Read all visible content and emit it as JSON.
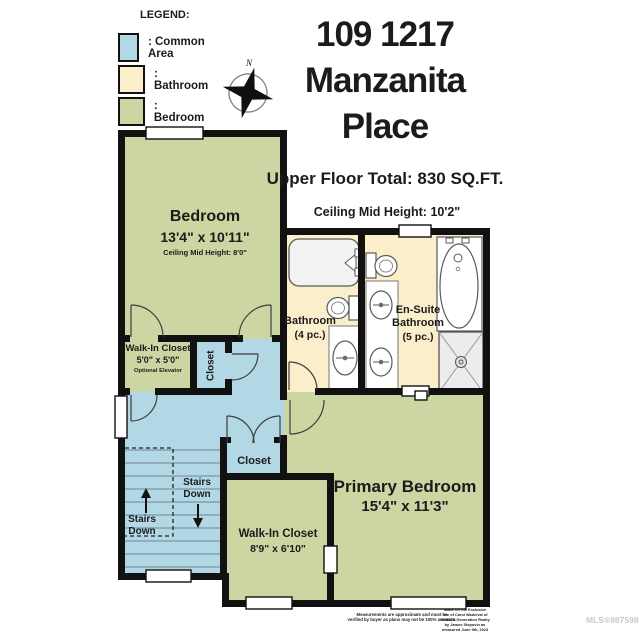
{
  "legend": {
    "title": "LEGEND:",
    "items": [
      {
        "label": ": Common Area",
        "color": "#b2d8e6"
      },
      {
        "label": ": Bathroom",
        "color": "#fbeeca"
      },
      {
        "label": ": Bedroom",
        "color": "#cbd6a3"
      }
    ]
  },
  "compass": {
    "north_label": "N"
  },
  "header": {
    "address_line1": "109 1217",
    "address_line2": "Manzanita",
    "address_line3": "Place",
    "floor_total": "Upper Floor Total: 830 SQ.FT.",
    "ceiling_height": "Ceiling Mid Height: 10'2\""
  },
  "rooms": {
    "bedroom": {
      "name": "Bedroom",
      "dims": "13'4\" x 10'11\"",
      "note": "Ceiling Mid Height: 8'0\""
    },
    "walk_in_closet_small": {
      "name": "Walk-In Closet",
      "dims": "5'0\" x 5'0\"",
      "note": "Optional Elevator"
    },
    "hall_closet": {
      "name": "Closet"
    },
    "bathroom_main": {
      "name": "Bathroom",
      "pieces": "(4 pc.)"
    },
    "ensuite": {
      "line1": "En-Suite",
      "line2": "Bathroom",
      "pieces": "(5 pc.)"
    },
    "primary_bedroom": {
      "name": "Primary Bedroom",
      "dims": "15'4\" x 11'3\""
    },
    "lower_closet": {
      "name": "Closet"
    },
    "walk_in_closet_large": {
      "name": "Walk-In Closet",
      "dims": "8'9\" x 6'10\""
    },
    "stairs_left": {
      "line1": "Stairs",
      "line2": "Down"
    },
    "stairs_right": {
      "line1": "Stairs",
      "line2": "Down"
    }
  },
  "footer": {
    "disclaimer_lines": [
      "Measurements are approximate and must be",
      "verified by buyer as plans may not be 100% accurate."
    ],
    "credit_lines": [
      "Made for the Exclusive",
      "use of Carol Wade/val of",
      "RE/MAX Generation Realty",
      "by James Stepovin as",
      "measured June 5th, 2023"
    ],
    "mls": "MLS®987598"
  },
  "colors": {
    "common_area": "#b2d8e6",
    "bathroom": "#fbeeca",
    "bedroom": "#cbd6a3",
    "wall": "#111111",
    "watermark": "#c9c9c9"
  }
}
